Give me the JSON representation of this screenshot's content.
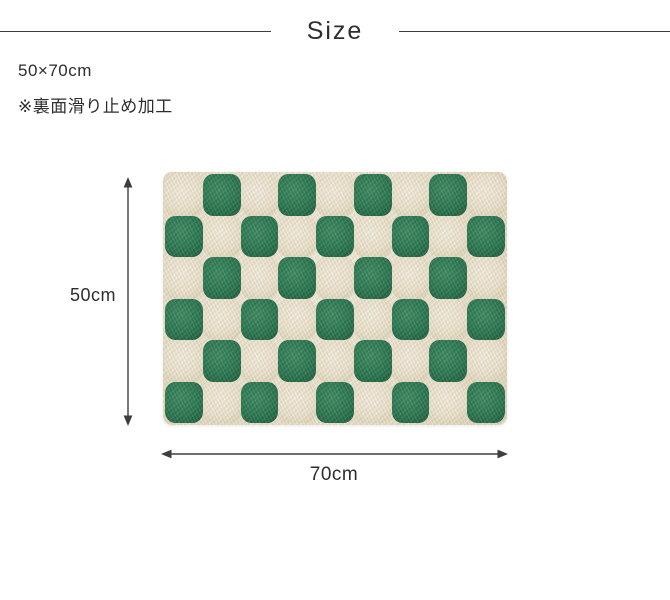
{
  "page": {
    "background": "#ffffff"
  },
  "header": {
    "title": "Size"
  },
  "specs": {
    "size_text": "50×70cm",
    "note_text": "※裏面滑り止め加工"
  },
  "diagram": {
    "height_label": "50cm",
    "width_label": "70cm",
    "rug": {
      "pattern": "checkerboard",
      "rows": 6,
      "cols": 9,
      "green_color": "#2d7a53",
      "cream_color": "#f1e8d1"
    }
  },
  "colors": {
    "text": "#2e2e2e",
    "rule_line": "#3c3c3c",
    "arrow": "#3e3e3e"
  }
}
